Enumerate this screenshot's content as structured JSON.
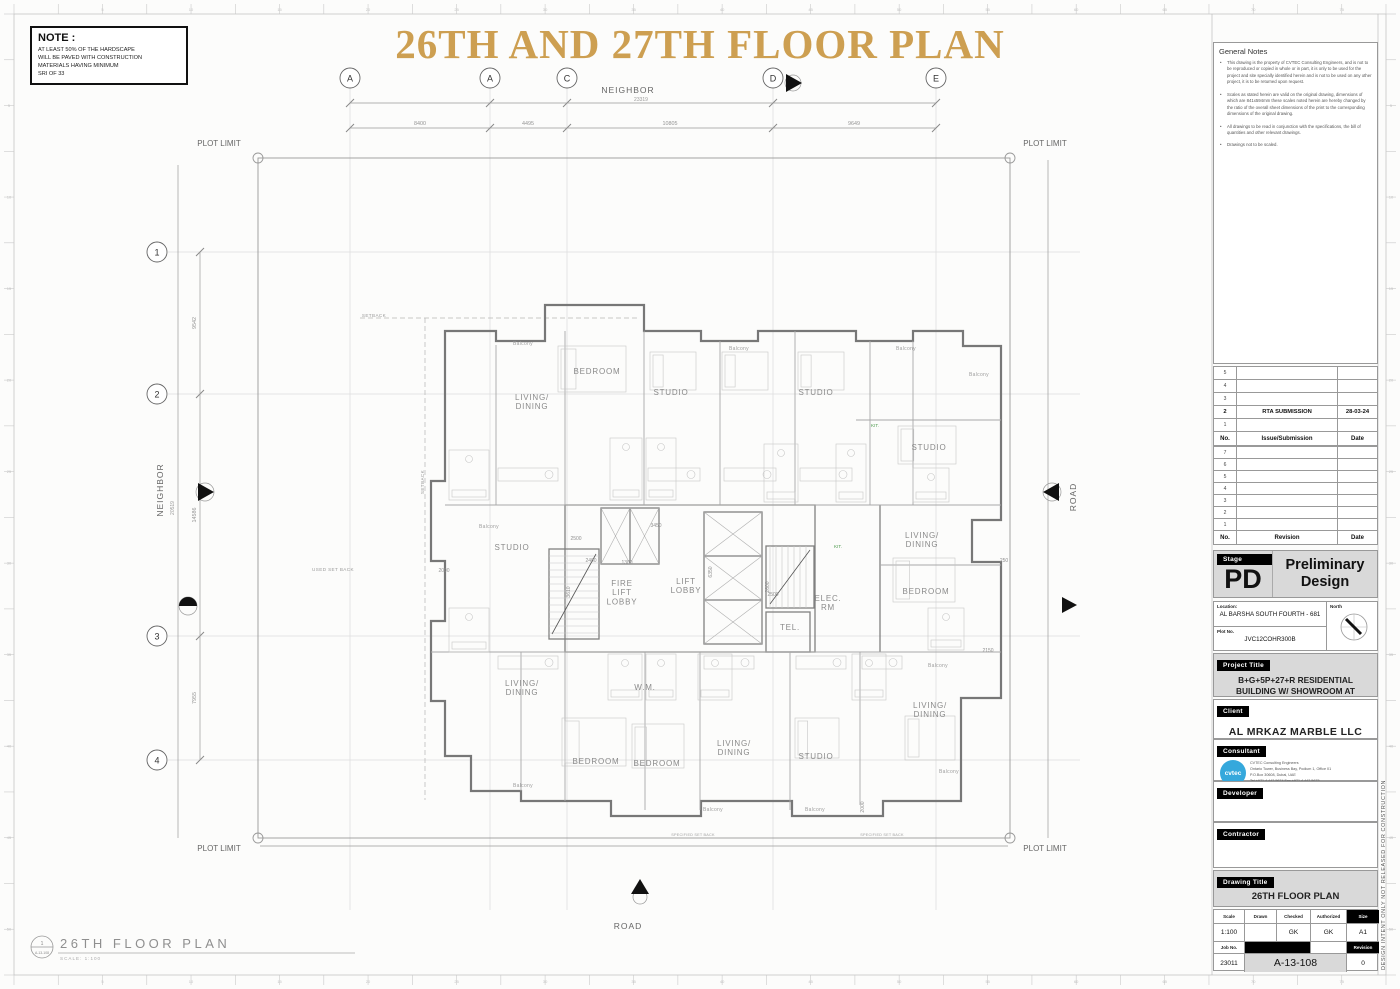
{
  "page": {
    "banner": "26TH AND 27TH FLOOR PLAN",
    "gold": "#cd9f51"
  },
  "note_box": {
    "title": "NOTE :",
    "lines": [
      "AT LEAST 50% OF THE HARDSCAPE",
      "WILL BE PAVED WITH CONSTRUCTION",
      "MATERIALS HAVING MINIMUM",
      "SRI OF 33"
    ]
  },
  "plan": {
    "grid_cols": [
      {
        "label": "A",
        "x": 350
      },
      {
        "label": "A",
        "x": 490
      },
      {
        "label": "C",
        "x": 567
      },
      {
        "label": "D",
        "x": 773
      },
      {
        "label": "E",
        "x": 936
      }
    ],
    "grid_rows": [
      {
        "label": "1",
        "y": 252
      },
      {
        "label": "2",
        "y": 394
      },
      {
        "label": "3",
        "y": 636
      },
      {
        "label": "4",
        "y": 760
      }
    ],
    "edge_top": "NEIGHBOR",
    "edge_left": "NEIGHBOR",
    "edge_right": "ROAD",
    "edge_bottom": "ROAD",
    "plot_limit": "PLOT LIMIT",
    "top_overall": "23319",
    "left_overall": "20519",
    "top_dims": [
      {
        "t": "8400",
        "x": 420
      },
      {
        "t": "4495",
        "x": 528
      },
      {
        "t": "10805",
        "x": 670
      },
      {
        "t": "9649",
        "x": 854
      }
    ],
    "left_dims": [
      {
        "t": "9542",
        "y": 323
      },
      {
        "t": "14586",
        "y": 515
      },
      {
        "t": "7955",
        "y": 698
      }
    ],
    "rooms": [
      {
        "t": "BEDROOM",
        "x": 597,
        "y": 374
      },
      {
        "t": "STUDIO",
        "x": 671,
        "y": 395
      },
      {
        "t": "STUDIO",
        "x": 816,
        "y": 395
      },
      {
        "t": "LIVING/\nDINING",
        "x": 532,
        "y": 400
      },
      {
        "t": "STUDIO",
        "x": 929,
        "y": 450
      },
      {
        "t": "STUDIO",
        "x": 512,
        "y": 550
      },
      {
        "t": "FIRE\nLIFT\nLOBBY",
        "x": 622,
        "y": 586
      },
      {
        "t": "LIFT\nLOBBY",
        "x": 686,
        "y": 584
      },
      {
        "t": "LIVING/\nDINING",
        "x": 922,
        "y": 538
      },
      {
        "t": "BEDROOM",
        "x": 926,
        "y": 594
      },
      {
        "t": "ELEC.\nRM",
        "x": 828,
        "y": 601
      },
      {
        "t": "TEL.",
        "x": 790,
        "y": 630
      },
      {
        "t": "W.M.",
        "x": 645,
        "y": 690
      },
      {
        "t": "LIVING/\nDINING",
        "x": 522,
        "y": 686
      },
      {
        "t": "BEDROOM",
        "x": 596,
        "y": 764
      },
      {
        "t": "BEDROOM",
        "x": 657,
        "y": 766
      },
      {
        "t": "LIVING/\nDINING",
        "x": 734,
        "y": 746
      },
      {
        "t": "STUDIO",
        "x": 816,
        "y": 759
      },
      {
        "t": "LIVING/\nDINING",
        "x": 930,
        "y": 708
      }
    ],
    "balcony_label": "Balcony",
    "balconies": [
      [
        523,
        345
      ],
      [
        739,
        350
      ],
      [
        906,
        350
      ],
      [
        979,
        376
      ],
      [
        489,
        528
      ],
      [
        938,
        667
      ],
      [
        523,
        787
      ],
      [
        713,
        811
      ],
      [
        815,
        811
      ],
      [
        949,
        773
      ]
    ],
    "small_dims": [
      [
        "2500",
        576,
        540,
        0
      ],
      [
        "2400",
        591,
        562,
        0
      ],
      [
        "3450",
        656,
        527,
        0
      ],
      [
        "1300",
        627,
        564,
        0
      ],
      [
        "3610",
        570,
        592,
        1
      ],
      [
        "6350",
        712,
        572,
        1
      ],
      [
        "2600",
        769,
        587,
        1
      ],
      [
        "2500",
        773,
        596,
        0
      ],
      [
        "2000",
        444,
        572,
        0
      ],
      [
        "250",
        1004,
        562,
        0
      ],
      [
        "2150",
        988,
        652,
        0
      ],
      [
        "2000",
        864,
        807,
        1
      ]
    ],
    "setbacks": [
      [
        "SETBACK",
        374,
        317,
        0
      ],
      [
        "SETBACK",
        424,
        482,
        1
      ],
      [
        "USED SET BACK",
        333,
        571,
        0
      ]
    ],
    "green_labels": [
      [
        "KIT.",
        875,
        427
      ],
      [
        "KIT.",
        838,
        548
      ]
    ],
    "bottom_notes": [
      [
        "SPECIFIED SET BACK",
        693,
        836
      ],
      [
        "SPECIFIED SET BACK",
        882,
        836
      ]
    ],
    "caption": {
      "title": "26TH FLOOR PLAN",
      "scale": "SCALE: 1:100",
      "ref_top": "1",
      "ref_bottom": "A-13-108"
    },
    "ruler_top": [
      5,
      10,
      15,
      20,
      25,
      30,
      35,
      40,
      45,
      50,
      55,
      60,
      65,
      70,
      75
    ],
    "ruler_side": [
      5,
      10,
      15,
      20,
      25,
      30,
      35,
      40,
      45,
      50
    ]
  },
  "titleblock": {
    "general_notes": {
      "title": "General Notes",
      "items": [
        "This drawing is the property of CVTEC Consulting Engineers, and is not to be reproduced or copied in whole or in part, it is only to be used for the project and site specially identified herein and is not to be used on any other project, it is to be returned upon request.",
        "Scales as stated herein are valid on the original drawing, dimensions of which are 841x594mm these scales noted herein are hereby changed by the ratio of the overall sheet dimensions of the print to the corresponding dimensions of the original drawing.",
        "All drawings to be read in conjunction with the specifications, the bill of quantities and other relevant drawings.",
        "Drawings not to be scaled."
      ]
    },
    "submission": {
      "headers": [
        "No.",
        "Issue/Submission",
        "Date"
      ],
      "rows": [
        [
          "5",
          "",
          ""
        ],
        [
          "4",
          "",
          ""
        ],
        [
          "3",
          "",
          ""
        ],
        [
          "2",
          "RTA SUBMISSION",
          "28-03-24"
        ],
        [
          "1",
          "",
          ""
        ]
      ]
    },
    "revision": {
      "headers": [
        "No.",
        "Revision",
        "Date"
      ],
      "rows": [
        [
          "7",
          "",
          ""
        ],
        [
          "6",
          "",
          ""
        ],
        [
          "5",
          "",
          ""
        ],
        [
          "4",
          "",
          ""
        ],
        [
          "3",
          "",
          ""
        ],
        [
          "2",
          "",
          ""
        ],
        [
          "1",
          "",
          ""
        ]
      ]
    },
    "stage": {
      "label": "Stage",
      "code": "PD",
      "name": "Preliminary Design"
    },
    "location": {
      "label": "Location:",
      "value": "AL BARSHA SOUTH FOURTH - 681"
    },
    "plot": {
      "label": "Plot No.",
      "value": "JVC12COHR300B"
    },
    "north_label": "North",
    "project": {
      "label": "Project Title",
      "value": "B+G+5P+27+R RESIDENTIAL BUILDING W/ SHOWROOM AT GROUND"
    },
    "client": {
      "label": "Client",
      "value": "AL MRKAZ MARBLE LLC"
    },
    "consultant": {
      "label": "Consultant",
      "logo": "cvtec",
      "address": "CVTEC Consulting Engineers\nOntario Tower, Business Bay, Podium 1, Office 01\nP.O.Box 30608, Dubai, UAE\nTel +971 4 442 5674        Fax +971 4 442 5675"
    },
    "developer_label": "Developer",
    "contractor_label": "Contractor",
    "drawing": {
      "label": "Drawing Title",
      "value": "26TH FLOOR PLAN"
    },
    "info": {
      "scale_label": "Scale",
      "drawn_label": "Drawn",
      "checked_label": "Checked",
      "authorized_label": "Authorized",
      "size_label": "Size",
      "scale": "1:100",
      "drawn": "",
      "checked": "GK",
      "authorized": "GK",
      "size": "A1",
      "job_label": "Job No.",
      "job": "23011",
      "dwg_no": "A-13-108",
      "rev_label": "Revision",
      "rev": "0"
    }
  },
  "side_strip": "DESIGN INTENT ONLY NOT RELEASED FOR CONSTRUCTION"
}
